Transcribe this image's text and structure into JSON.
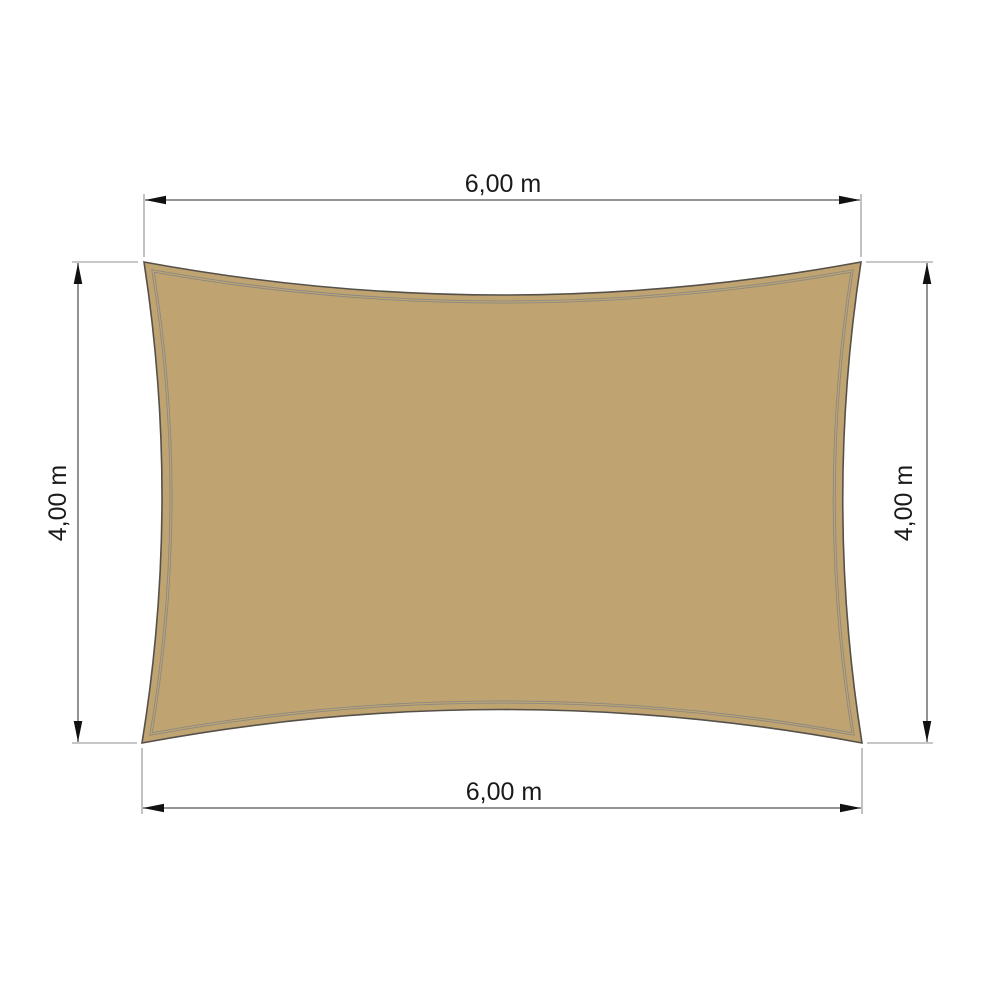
{
  "page": {
    "background_color": "#ffffff"
  },
  "diagram": {
    "type": "shade-sail-dimension-drawing",
    "sail": {
      "shape": "rectangle-with-concave-edges",
      "fill_color": "#bfa472",
      "outline_color": "#55504a",
      "seam_color": "#8b8882"
    },
    "dimensions": {
      "top": {
        "label": "6,00 m",
        "value_m": 6.0,
        "orientation": "horizontal"
      },
      "bottom": {
        "label": "6,00 m",
        "value_m": 6.0,
        "orientation": "horizontal"
      },
      "left": {
        "label": "4,00 m",
        "value_m": 4.0,
        "orientation": "vertical"
      },
      "right": {
        "label": "4,00 m",
        "value_m": 4.0,
        "orientation": "vertical"
      }
    },
    "style": {
      "dimension_line_color": "#565656",
      "extension_line_color": "#8f8f8f",
      "arrowhead_color": "#111111",
      "label_color": "#1a1a1a"
    }
  }
}
